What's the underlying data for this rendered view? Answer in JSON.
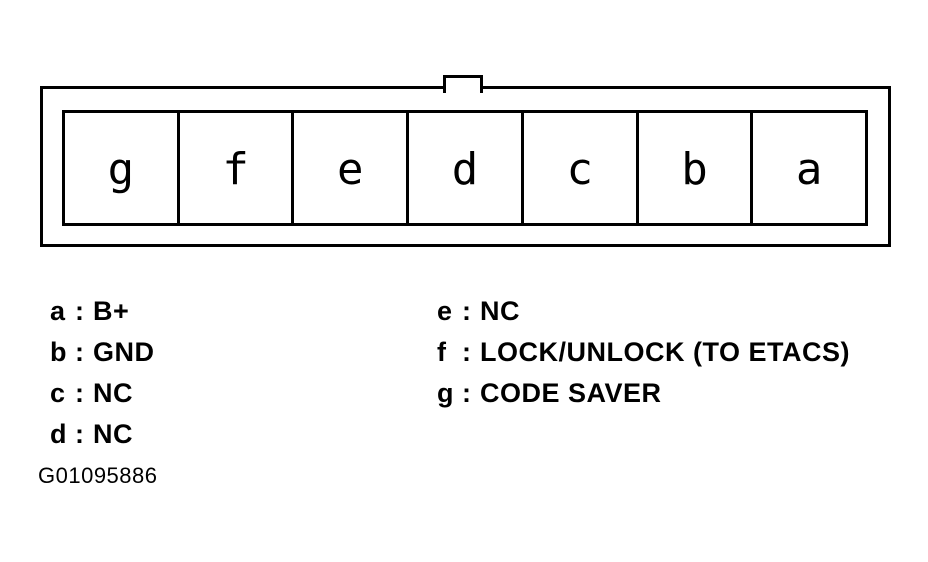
{
  "connector": {
    "pins": [
      "g",
      "f",
      "e",
      "d",
      "c",
      "b",
      "a"
    ]
  },
  "legend": {
    "separator": ":",
    "items": [
      {
        "pin": "a",
        "desc": "B+"
      },
      {
        "pin": "b",
        "desc": "GND"
      },
      {
        "pin": "c",
        "desc": "NC"
      },
      {
        "pin": "d",
        "desc": "NC"
      },
      {
        "pin": "e",
        "desc": "NC"
      },
      {
        "pin": "f",
        "desc": "LOCK/UNLOCK (TO ETACS)"
      },
      {
        "pin": "g",
        "desc": "CODE SAVER"
      }
    ]
  },
  "figure_id": "G01095886",
  "colors": {
    "line": "#000000",
    "background": "#ffffff"
  }
}
